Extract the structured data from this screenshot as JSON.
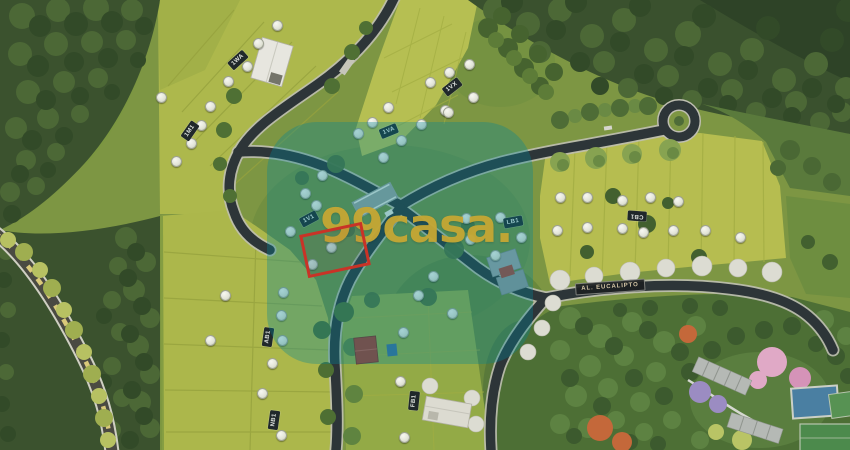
{
  "watermark": {
    "text": "99casa.",
    "overlay_rgba": "rgba(0,134,152,0.33)",
    "text_color": "rgba(198,168,52,0.95)"
  },
  "map": {
    "street_sign": {
      "label": "AL. EUCALIPTO",
      "x": 610,
      "y": 287,
      "rot": -4
    },
    "block_badges": [
      {
        "label": "1WA",
        "x": 238,
        "y": 60,
        "rot": -42
      },
      {
        "label": "1M1",
        "x": 190,
        "y": 131,
        "rot": -55
      },
      {
        "label": "1VA",
        "x": 389,
        "y": 131,
        "rot": -22
      },
      {
        "label": "1VX",
        "x": 452,
        "y": 87,
        "rot": -38
      },
      {
        "label": "1V1",
        "x": 309,
        "y": 219,
        "rot": -28
      },
      {
        "label": "LB1",
        "x": 513,
        "y": 222,
        "rot": -10
      },
      {
        "label": "CB1",
        "x": 637,
        "y": 216,
        "rot": 184
      },
      {
        "label": "AB1",
        "x": 268,
        "y": 337,
        "rot": -82
      },
      {
        "label": "NB1",
        "x": 274,
        "y": 420,
        "rot": -82
      },
      {
        "label": "FB1",
        "x": 414,
        "y": 401,
        "rot": -84
      }
    ],
    "highlighted_lot": {
      "x": 303,
      "y": 228,
      "width": 58,
      "height": 38,
      "rot": -12,
      "color": "#c93327"
    },
    "lot_markers": [
      [
        277,
        25
      ],
      [
        258,
        43
      ],
      [
        247,
        66
      ],
      [
        228,
        81
      ],
      [
        210,
        106
      ],
      [
        201,
        125
      ],
      [
        191,
        143
      ],
      [
        176,
        161
      ],
      [
        161,
        97
      ],
      [
        388,
        107
      ],
      [
        372,
        122
      ],
      [
        358,
        133
      ],
      [
        401,
        140
      ],
      [
        421,
        124
      ],
      [
        445,
        110
      ],
      [
        430,
        82
      ],
      [
        449,
        72
      ],
      [
        469,
        64
      ],
      [
        473,
        97
      ],
      [
        448,
        112
      ],
      [
        322,
        175
      ],
      [
        305,
        193
      ],
      [
        316,
        205
      ],
      [
        290,
        231
      ],
      [
        312,
        264
      ],
      [
        331,
        247
      ],
      [
        383,
        157
      ],
      [
        500,
        217
      ],
      [
        521,
        237
      ],
      [
        470,
        239
      ],
      [
        433,
        276
      ],
      [
        418,
        295
      ],
      [
        466,
        218
      ],
      [
        495,
        255
      ],
      [
        560,
        197
      ],
      [
        587,
        197
      ],
      [
        622,
        200
      ],
      [
        650,
        197
      ],
      [
        678,
        201
      ],
      [
        557,
        230
      ],
      [
        587,
        227
      ],
      [
        622,
        228
      ],
      [
        643,
        232
      ],
      [
        673,
        230
      ],
      [
        705,
        230
      ],
      [
        740,
        237
      ],
      [
        283,
        292
      ],
      [
        281,
        315
      ],
      [
        282,
        340
      ],
      [
        272,
        363
      ],
      [
        262,
        393
      ],
      [
        281,
        435
      ],
      [
        225,
        295
      ],
      [
        210,
        340
      ],
      [
        403,
        332
      ],
      [
        400,
        381
      ],
      [
        404,
        437
      ],
      [
        452,
        313
      ]
    ]
  }
}
